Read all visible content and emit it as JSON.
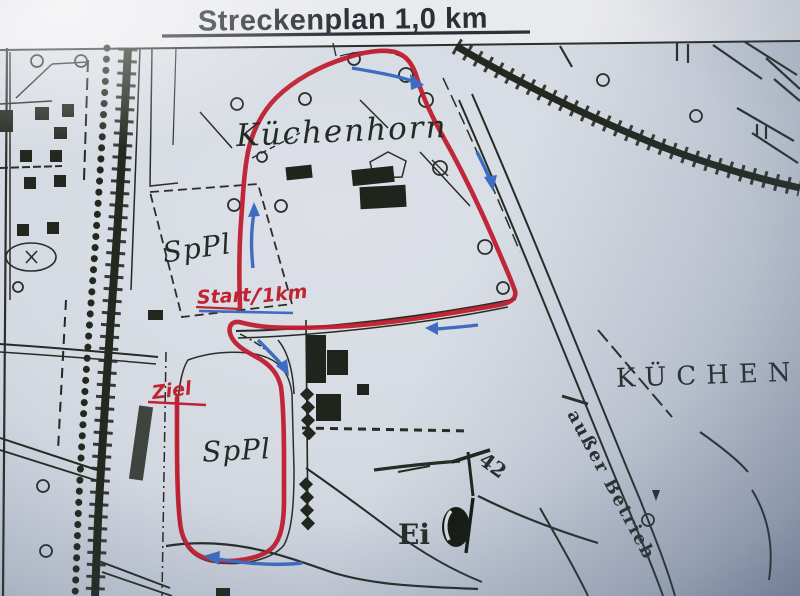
{
  "title": "Streckenplan 1,0 km",
  "map": {
    "labels": {
      "area": "Küchenhorn",
      "upper_field": "SpPl",
      "lower_field": "SpPl",
      "start": "Start",
      "distance": "1km",
      "finish": "Ziel",
      "egg": "Ei",
      "marker": "42",
      "railway_note": "außer Betrieb",
      "district": "KÜCHEN"
    },
    "colors": {
      "route": "#bf1c2e",
      "direction_arrows": "#3d6cc2",
      "map_print": "#262b24",
      "handwriting": "#c02433",
      "paper": "#d7dbe2"
    },
    "symbols": {
      "route": "hand-drawn-route-line",
      "direction": "direction-arrow-icon",
      "railway": "railway-embankment-sawtooth",
      "tree": "tree-circle",
      "monument": "egg-monument-symbol"
    }
  }
}
